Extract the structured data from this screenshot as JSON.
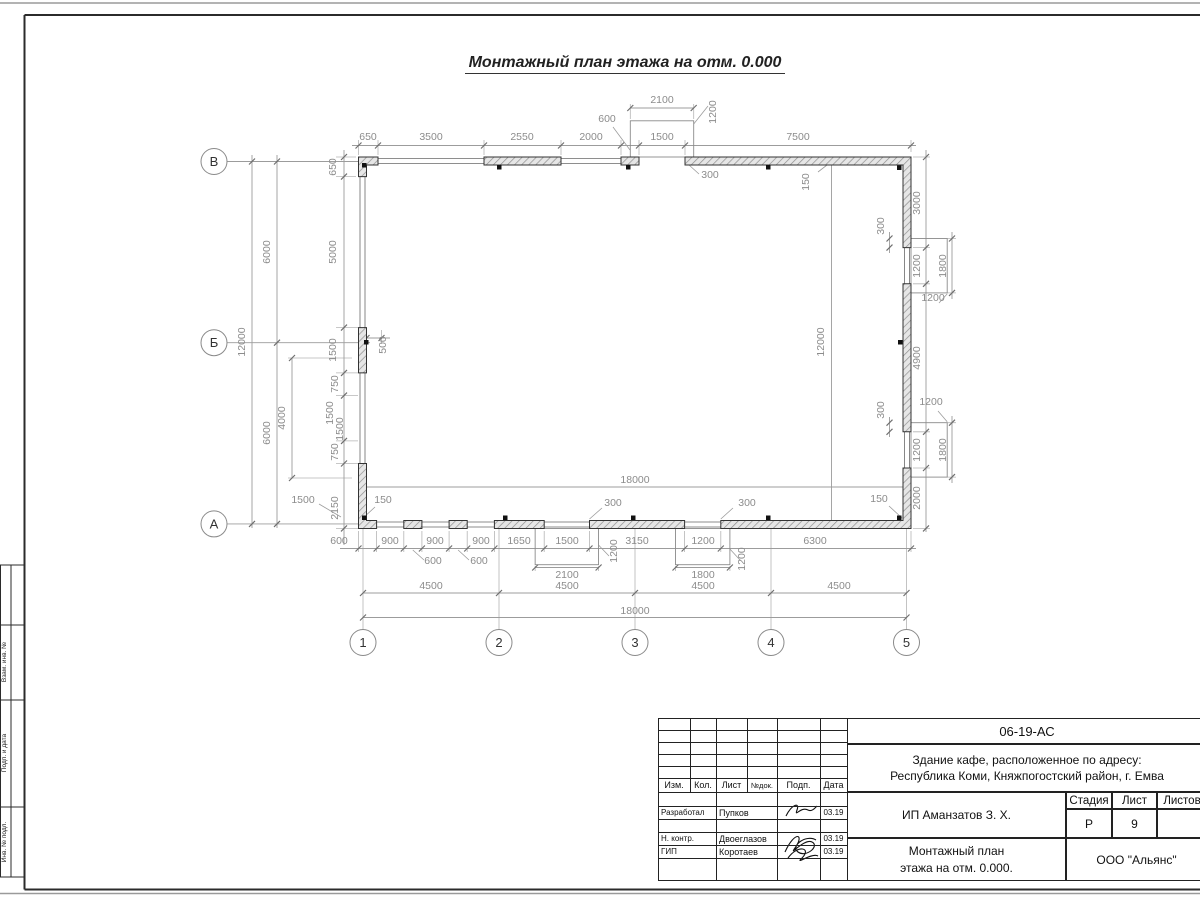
{
  "caption": "Монтажный план этажа на отм. 0.000",
  "colors": {
    "paper": "#ffffff",
    "dim_line": "#999999",
    "dim_text": "#8c8c8c",
    "wall": "#333333"
  },
  "drawing": {
    "row_axes": [
      {
        "label": "В",
        "x": 214,
        "y": 161.5
      },
      {
        "label": "Б",
        "x": 214,
        "y": 342.7
      },
      {
        "label": "А",
        "x": 214,
        "y": 523.9
      }
    ],
    "col_axes": [
      {
        "label": "1",
        "x": 363,
        "y": 642.5
      },
      {
        "label": "2",
        "x": 499,
        "y": 642.5
      },
      {
        "label": "3",
        "x": 635,
        "y": 642.5
      },
      {
        "label": "4",
        "x": 771,
        "y": 642.5
      },
      {
        "label": "5",
        "x": 906.5,
        "y": 642.5
      }
    ],
    "dimensions": [
      {
        "t": "650",
        "x": 368,
        "y": 140,
        "r": 0
      },
      {
        "t": "3500",
        "x": 431,
        "y": 140,
        "r": 0
      },
      {
        "t": "2550",
        "x": 522,
        "y": 140,
        "r": 0
      },
      {
        "t": "2000",
        "x": 591,
        "y": 140,
        "r": 0
      },
      {
        "t": "1500",
        "x": 662,
        "y": 140,
        "r": 0
      },
      {
        "t": "7500",
        "x": 798,
        "y": 140,
        "r": 0
      },
      {
        "t": "2100",
        "x": 662,
        "y": 103,
        "r": 0
      },
      {
        "t": "600",
        "x": 607,
        "y": 122,
        "r": 0
      },
      {
        "t": "1200",
        "x": 716,
        "y": 112,
        "r": -90
      },
      {
        "t": "300",
        "x": 710,
        "y": 178,
        "r": 0
      },
      {
        "t": "650",
        "x": 336,
        "y": 167,
        "r": -90
      },
      {
        "t": "150",
        "x": 809,
        "y": 182,
        "r": -90
      },
      {
        "t": "12000",
        "x": 245,
        "y": 342,
        "r": -90
      },
      {
        "t": "6000",
        "x": 270,
        "y": 252,
        "r": -90
      },
      {
        "t": "6000",
        "x": 270,
        "y": 433,
        "r": -90
      },
      {
        "t": "5000",
        "x": 336,
        "y": 252,
        "r": -90
      },
      {
        "t": "1500",
        "x": 336,
        "y": 350,
        "r": -90
      },
      {
        "t": "750",
        "x": 338,
        "y": 384,
        "r": -90
      },
      {
        "t": "1500",
        "x": 333,
        "y": 413,
        "r": -90
      },
      {
        "t": "1500",
        "x": 343,
        "y": 429,
        "r": -90
      },
      {
        "t": "750",
        "x": 338,
        "y": 452,
        "r": -90
      },
      {
        "t": "2150",
        "x": 338,
        "y": 508,
        "r": -90
      },
      {
        "t": "4000",
        "x": 285,
        "y": 418,
        "r": -90
      },
      {
        "t": "500",
        "x": 386,
        "y": 345,
        "r": -90
      },
      {
        "t": "1500",
        "x": 303,
        "y": 503,
        "r": 0
      },
      {
        "t": "150",
        "x": 383,
        "y": 503,
        "r": 0
      },
      {
        "t": "600",
        "x": 339,
        "y": 544,
        "r": 0
      },
      {
        "t": "900",
        "x": 390,
        "y": 544,
        "r": 0
      },
      {
        "t": "900",
        "x": 435,
        "y": 544,
        "r": 0
      },
      {
        "t": "900",
        "x": 481,
        "y": 544,
        "r": 0
      },
      {
        "t": "1650",
        "x": 519,
        "y": 544,
        "r": 0
      },
      {
        "t": "1500",
        "x": 567,
        "y": 544,
        "r": 0
      },
      {
        "t": "3150",
        "x": 637,
        "y": 544,
        "r": 0
      },
      {
        "t": "1200",
        "x": 703,
        "y": 544,
        "r": 0
      },
      {
        "t": "6300",
        "x": 815,
        "y": 544,
        "r": 0
      },
      {
        "t": "600",
        "x": 433,
        "y": 564,
        "r": 0
      },
      {
        "t": "600",
        "x": 479,
        "y": 564,
        "r": 0
      },
      {
        "t": "2100",
        "x": 567,
        "y": 578,
        "r": 0
      },
      {
        "t": "1800",
        "x": 703,
        "y": 578,
        "r": 0
      },
      {
        "t": "1200",
        "x": 617,
        "y": 551,
        "r": -90
      },
      {
        "t": "1200",
        "x": 745,
        "y": 559,
        "r": -90
      },
      {
        "t": "300",
        "x": 613,
        "y": 506,
        "r": 0
      },
      {
        "t": "300",
        "x": 747,
        "y": 506,
        "r": 0
      },
      {
        "t": "150",
        "x": 879,
        "y": 502,
        "r": 0
      },
      {
        "t": "18000",
        "x": 635,
        "y": 483,
        "r": 0
      },
      {
        "t": "12000",
        "x": 824,
        "y": 342,
        "r": -90
      },
      {
        "t": "4500",
        "x": 431,
        "y": 589,
        "r": 0
      },
      {
        "t": "4500",
        "x": 567,
        "y": 589,
        "r": 0
      },
      {
        "t": "4500",
        "x": 703,
        "y": 589,
        "r": 0
      },
      {
        "t": "4500",
        "x": 839,
        "y": 589,
        "r": 0
      },
      {
        "t": "18000",
        "x": 635,
        "y": 614,
        "r": 0
      },
      {
        "t": "3000",
        "x": 920,
        "y": 203,
        "r": -90
      },
      {
        "t": "1200",
        "x": 920,
        "y": 266,
        "r": -90
      },
      {
        "t": "4900",
        "x": 920,
        "y": 358,
        "r": -90
      },
      {
        "t": "1200",
        "x": 920,
        "y": 450,
        "r": -90
      },
      {
        "t": "2000",
        "x": 920,
        "y": 498,
        "r": -90
      },
      {
        "t": "1800",
        "x": 946,
        "y": 266,
        "r": -90
      },
      {
        "t": "1800",
        "x": 946,
        "y": 450,
        "r": -90
      },
      {
        "t": "300",
        "x": 884,
        "y": 226,
        "r": -90
      },
      {
        "t": "300",
        "x": 884,
        "y": 410,
        "r": -90
      },
      {
        "t": "1200",
        "x": 933,
        "y": 301,
        "r": 0
      },
      {
        "t": "1200",
        "x": 931,
        "y": 405,
        "r": 0
      }
    ]
  },
  "side_column": {
    "labels": [
      {
        "text": "Взам. инв. №",
        "y": 662
      },
      {
        "text": "Подп. и дата",
        "y": 753
      },
      {
        "text": "Инв. № подл.",
        "y": 842
      }
    ]
  },
  "stamp": {
    "code": "06-19-АС",
    "object_line1": "Здание кафе, расположенное по адресу:",
    "object_line2": "Республика Коми, Княжпогостский район, г. Емва",
    "client": "ИП Аманзатов З. Х.",
    "doc_title_line1": "Монтажный план",
    "doc_title_line2": "этажа на отм. 0.000.",
    "company": "ООО \"Альянс\"",
    "col_izm": "Изм.",
    "col_kol": "Кол.",
    "col_list": "Лист",
    "col_ndoc": "№док.",
    "col_podp": "Подп.",
    "col_data": "Дата",
    "stage_label": "Стадия",
    "sheet_label": "Лист",
    "sheets_label": "Листов",
    "stage": "Р",
    "sheet_no": "9",
    "sheets_total": "",
    "row1_role": "Разработал",
    "row1_name": "Пупков",
    "row1_date": "03.19",
    "row2_role": "Н. контр.",
    "row2_name": "Двоеглазов",
    "row2_date": "03.19",
    "row3_role": "ГИП",
    "row3_name": "Коротаев",
    "row3_date": "03.19"
  }
}
